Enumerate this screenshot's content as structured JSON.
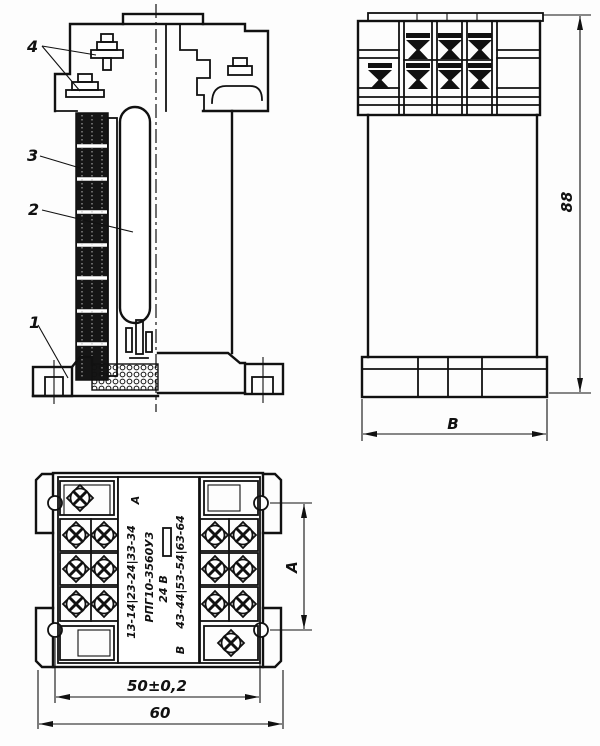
{
  "drawing": {
    "callouts": {
      "c1": "1",
      "c2": "2",
      "c3": "3",
      "c4": "4"
    },
    "dimensions": {
      "height": "88",
      "base_width": "В",
      "mount_span": "А",
      "hole_spacing": "50±0,2",
      "overall_width": "60"
    },
    "nameplate": {
      "row_a_contacts": "13-14|23-24|33-34",
      "mark_a": "А",
      "type_code": "РПГ10-3560У3",
      "voltage": "24 В",
      "mark_b": "В",
      "row_b_contacts": "43-44|53-54|63-64"
    }
  }
}
